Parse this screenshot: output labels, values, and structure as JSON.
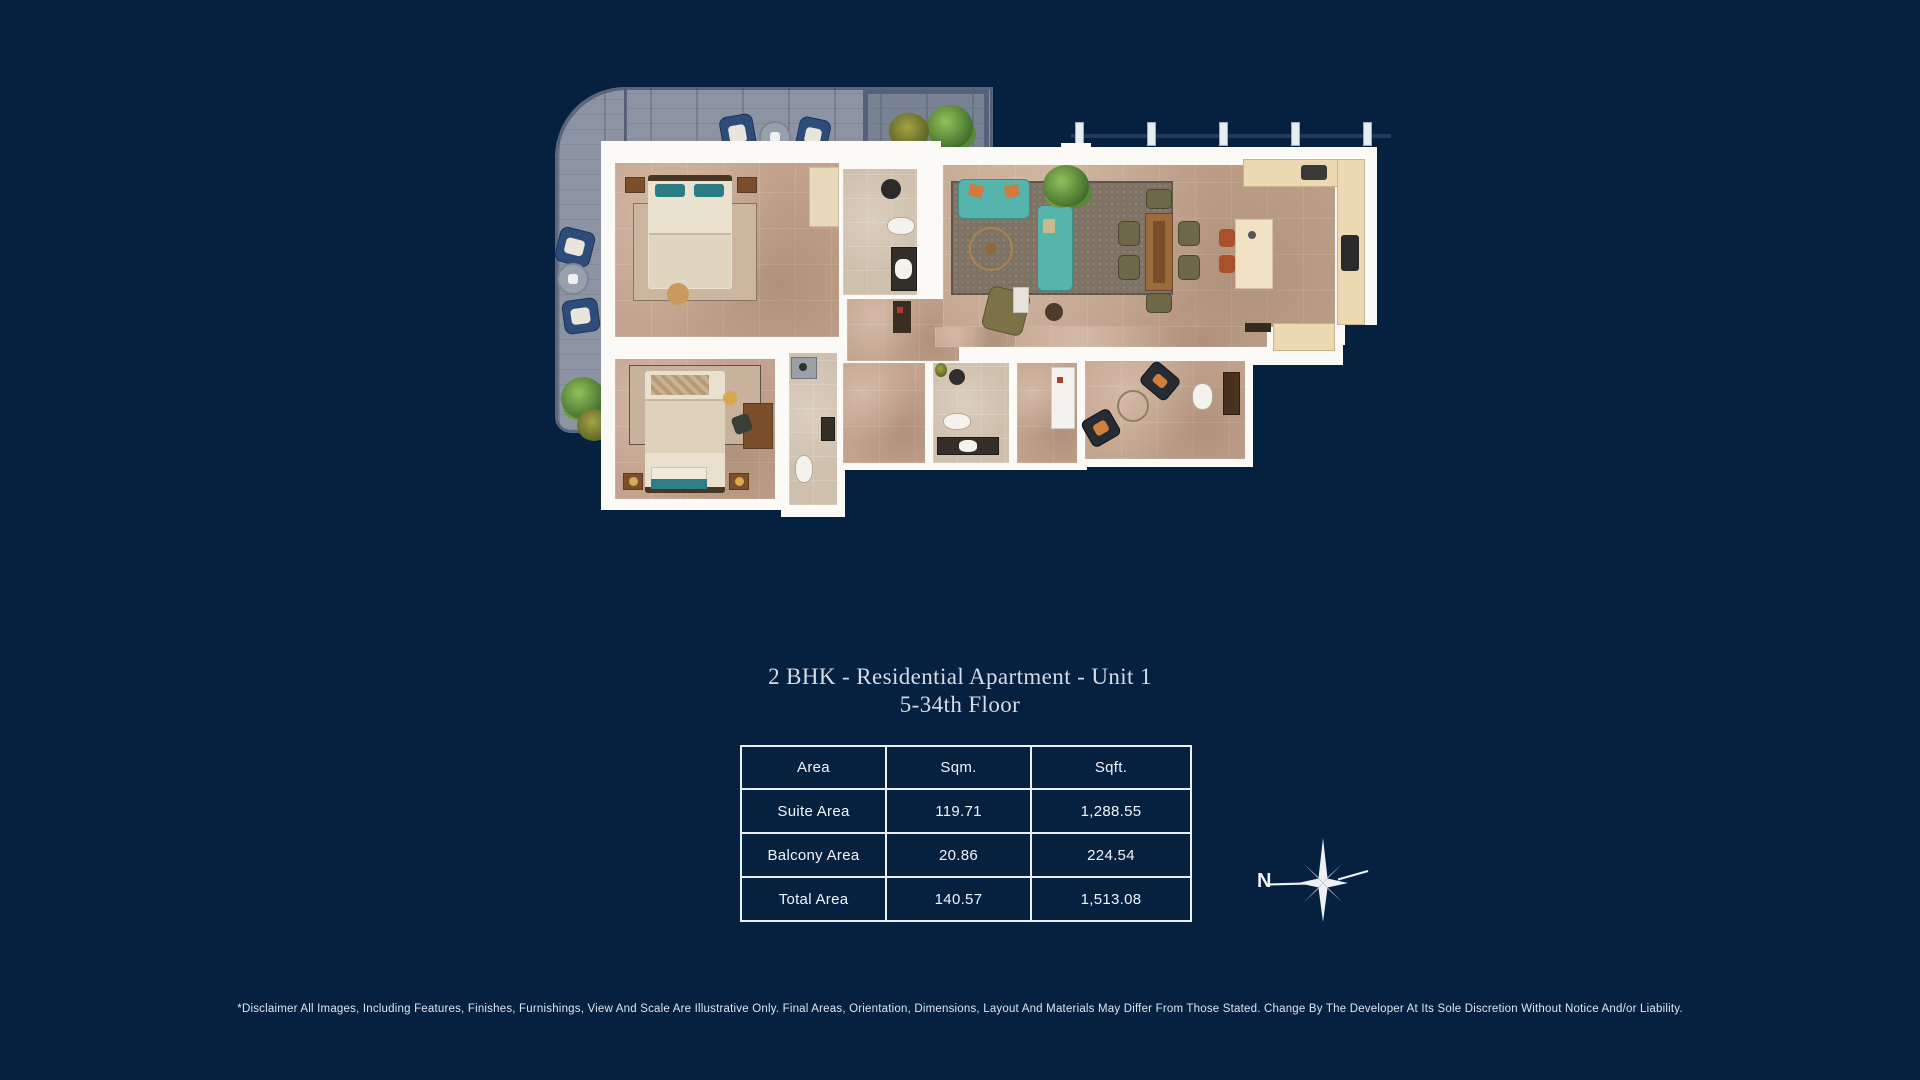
{
  "title": {
    "line1": "2 BHK - Residential Apartment - Unit 1",
    "line2": "5-34th Floor"
  },
  "area_table": {
    "headers": [
      "Area",
      "Sqm.",
      "Sqft."
    ],
    "rows": [
      {
        "label": "Suite Area",
        "sqm": "119.71",
        "sqft": "1,288.55"
      },
      {
        "label": "Balcony Area",
        "sqm": "20.86",
        "sqft": "224.54"
      },
      {
        "label": "Total Area",
        "sqm": "140.57",
        "sqft": "1,513.08"
      }
    ]
  },
  "compass": {
    "north_label": "N"
  },
  "disclaimer": "*Disclaimer All Images, Including Features, Finishes, Furnishings, View And Scale Are Illustrative Only. Final Areas, Orientation, Dimensions, Layout And Materials May Differ From Those Stated. Change By The Developer At Its Sole Discretion Without Notice And/or Liability.",
  "colors": {
    "background": "#062140",
    "wall_white": "#fbfaf6",
    "floor_tan": "#c2a38d",
    "deck_gray": "#8c94a3",
    "sofa_teal": "#55b4ab",
    "table_border": "#e9eff5"
  }
}
